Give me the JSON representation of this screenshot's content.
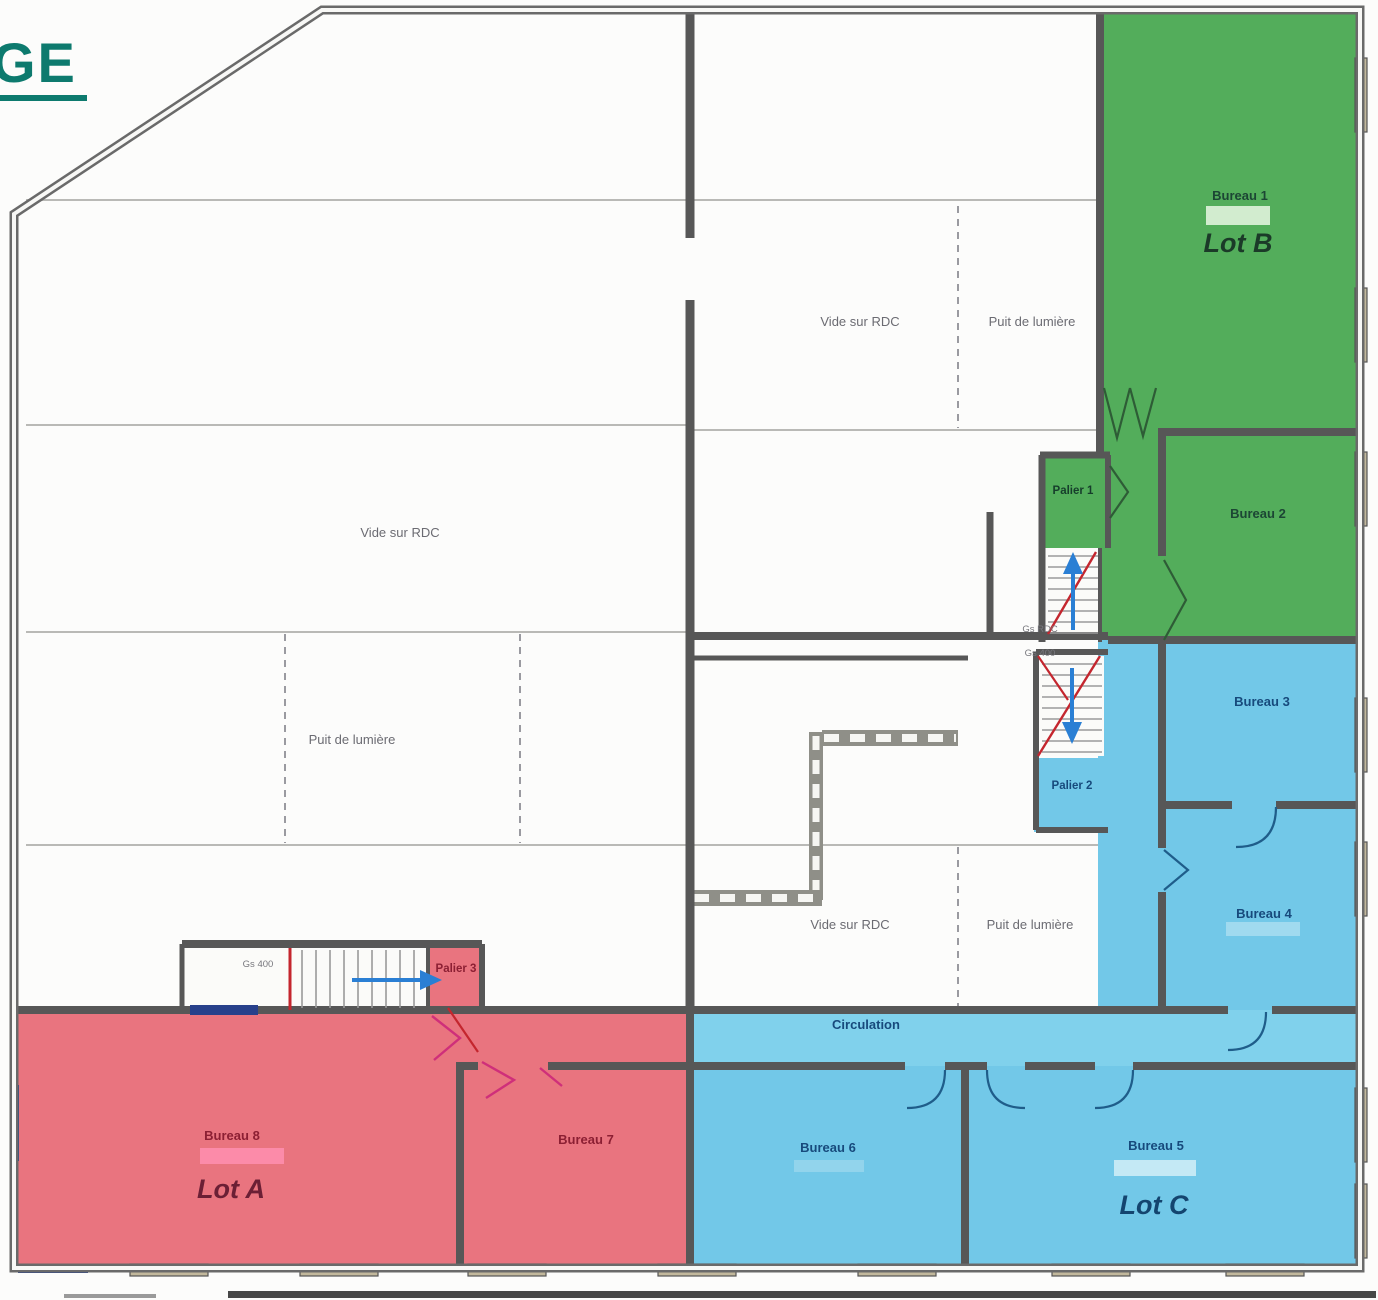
{
  "title": "GE",
  "colors": {
    "title": "#0d7a6e",
    "lot_a": "#e9747f",
    "lot_b": "#53ad5b",
    "lot_c": "#72c8e8",
    "corridor": "#80d1ec",
    "wall": "#5c5c5c",
    "outer_wall": "#6a6a6a",
    "stair_arrow": "#2a7fd4",
    "slope_line": "#c4262e",
    "door_magenta": "#cf2f7a",
    "window_frame": "#c2b89c",
    "window_blue": "#27408b"
  },
  "zones": {
    "lot_a": {
      "name": "Lot A",
      "color": "#e9747f",
      "rooms": [
        "Bureau 8",
        "Bureau 7"
      ]
    },
    "lot_b": {
      "name": "Lot B",
      "color": "#53ad5b",
      "rooms": [
        "Bureau 1",
        "Bureau 2"
      ]
    },
    "lot_c": {
      "name": "Lot C",
      "color": "#72c8e8",
      "rooms": [
        "Bureau 3",
        "Bureau 4",
        "Bureau 5",
        "Bureau 6"
      ]
    }
  },
  "labels": {
    "bureau1": "Bureau 1",
    "bureau2": "Bureau 2",
    "bureau3": "Bureau 3",
    "bureau4": "Bureau 4",
    "bureau5": "Bureau 5",
    "bureau6": "Bureau 6",
    "bureau7": "Bureau 7",
    "bureau8": "Bureau 8",
    "lot_a": "Lot A",
    "lot_b": "Lot B",
    "lot_c": "Lot C",
    "palier1": "Palier 1",
    "palier2": "Palier 2",
    "palier3": "Palier 3",
    "circulation": "Circulation",
    "vide_sur_rdc": "Vide sur RDC",
    "puit_de_lumiere": "Puit de lumière",
    "gs_rdc": "Gs RDC",
    "gs_400": "Gs 400"
  }
}
